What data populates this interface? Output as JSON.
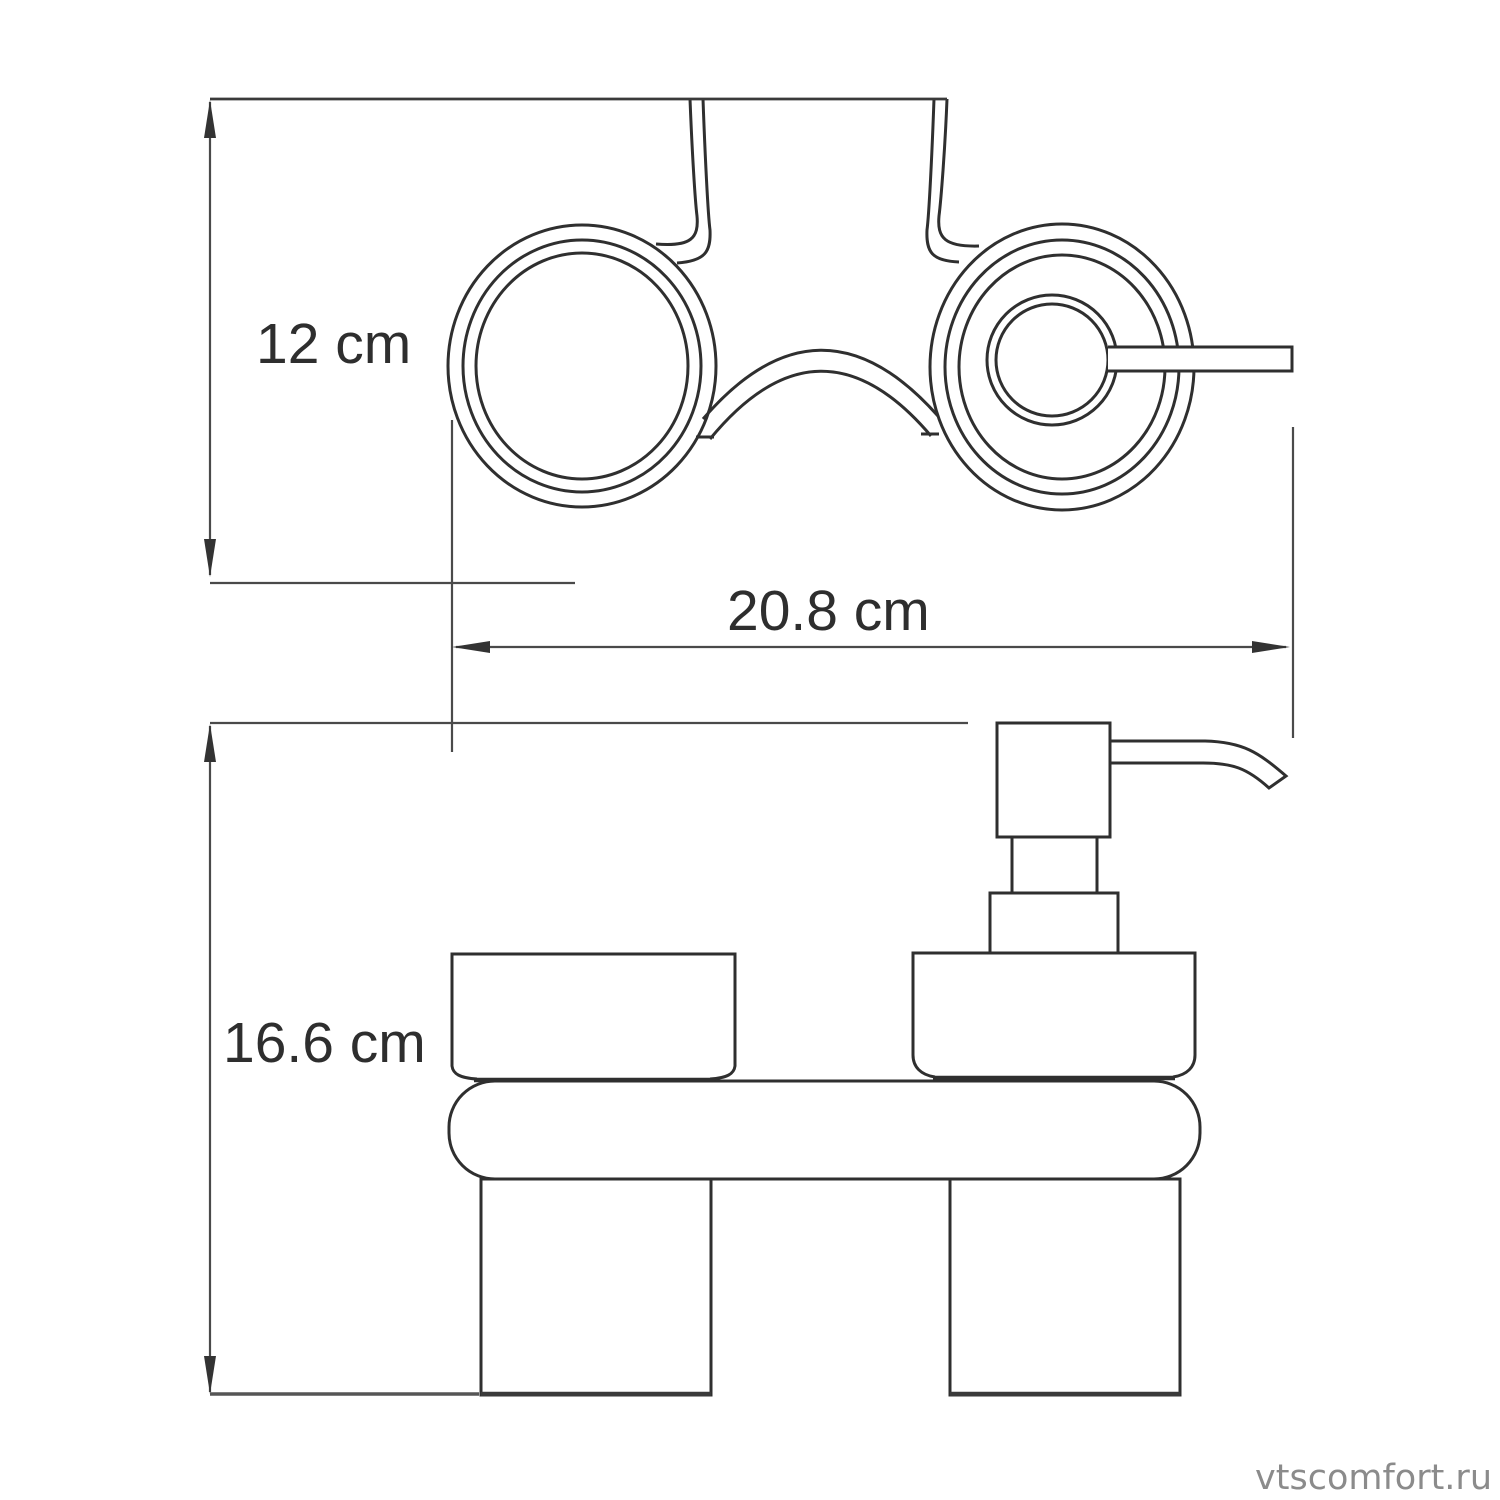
{
  "drawing": {
    "title": "Technical dimension drawing",
    "product": "Wall-mounted holder with glass tumbler and soap dispenser",
    "views": {
      "top_view": "plan view with two ring holders, mounting plate and dispenser pump spout",
      "front_view": "elevation with glass, dispenser pump, shelf and two lower cylinders"
    }
  },
  "dimensions": {
    "depth": {
      "label": "12 cm"
    },
    "width": {
      "label": "20.8 cm"
    },
    "height": {
      "label": "16.6 cm"
    }
  },
  "watermark": {
    "text": "vtscomfort.ru"
  },
  "colors": {
    "background": "#ffffff",
    "drawing_line": "#2f2f2f",
    "dimension_line": "#4a4a4a",
    "label_text": "#2e2e2e",
    "watermark_text": "#8b8b8b"
  }
}
